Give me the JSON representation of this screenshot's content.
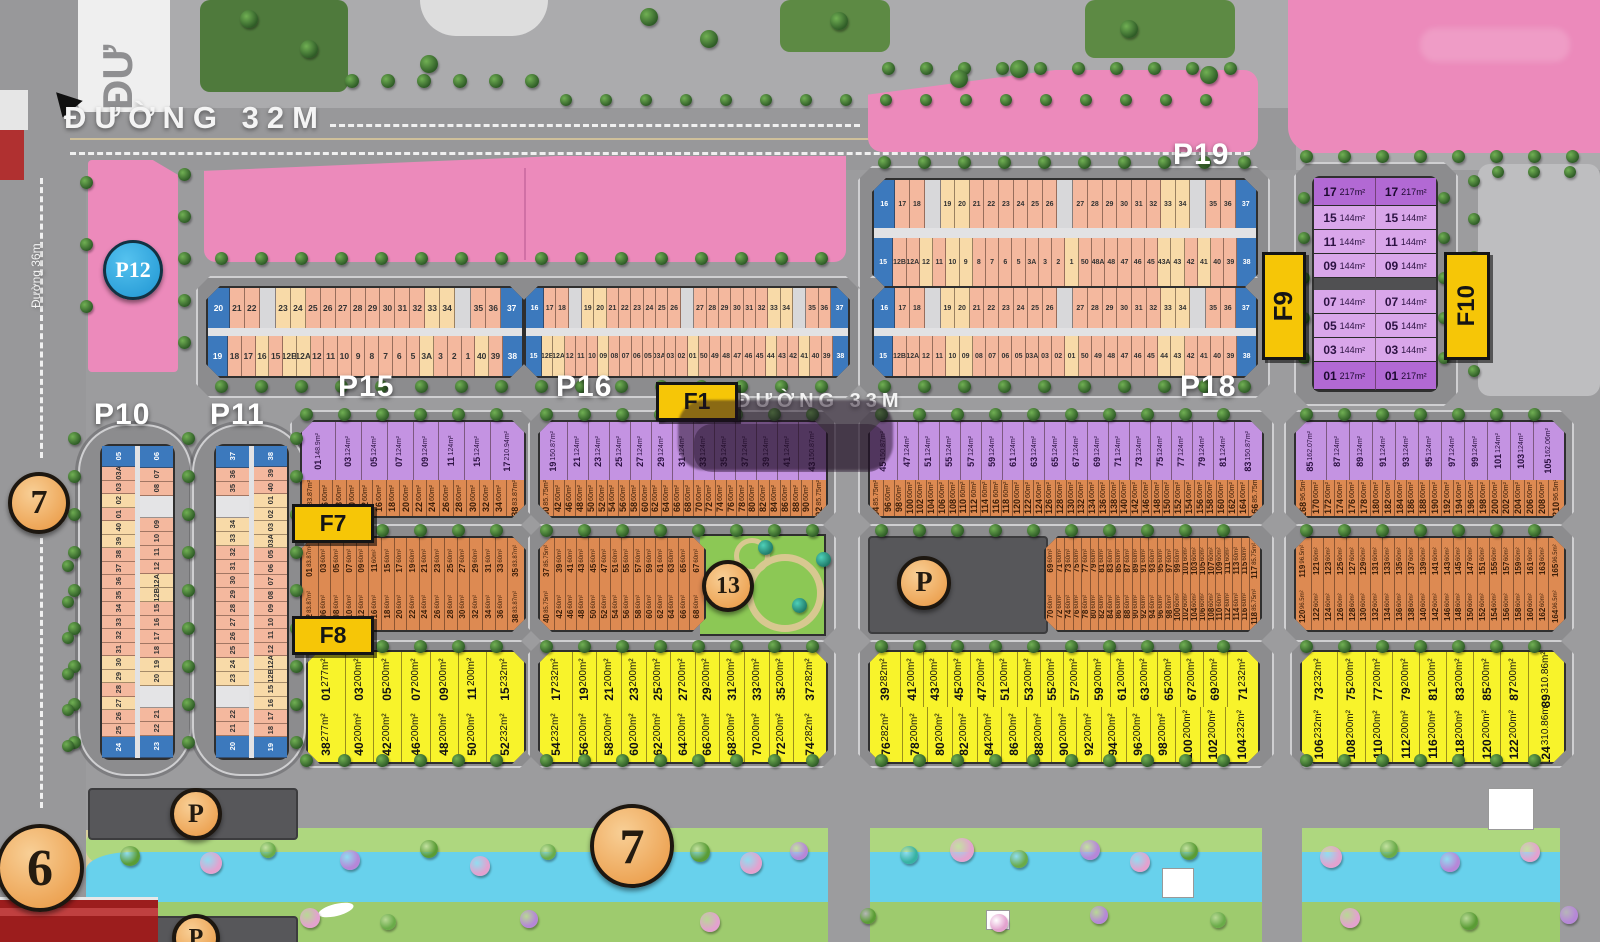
{
  "road_labels": {
    "top": "ĐƯỜNG 32M",
    "middle": "ĐƯỜNG 33M",
    "left_vertical": "Đường 36m",
    "top_left_partial": "ĐƯ"
  },
  "area_labels": {
    "p10": "P10",
    "p11": "P11",
    "p12": "P12",
    "p15": "P15",
    "p16": "P16",
    "p18": "P18",
    "p19": "P19"
  },
  "flag_labels": {
    "f1": "F1",
    "f7": "F7",
    "f8": "F8",
    "f9": "F9",
    "f10": "F10"
  },
  "markers": {
    "p12": "P12",
    "six": "6",
    "seven_road": "7",
    "seven_river": "7",
    "thirteen": "13",
    "parking": "P"
  },
  "colors": {
    "pink_building": "#ec8abb",
    "blue_plot": "#3c79bd",
    "salmon_plot": "#f4b89e",
    "cream_plot": "#f8daa8",
    "purple_plot": "#c493e2",
    "orange_plot": "#dd8a52",
    "yellow_plot": "#f8f32b",
    "flag_yellow": "#f6c607",
    "water": "#68d1ec",
    "bank_green": "#aed77f",
    "road_gray": "#9c9c9e",
    "marker_orange": "#e9953e",
    "marker_blue": "#1f95d2",
    "parking_gray": "#57575a",
    "red_band": "#9c1d1d"
  },
  "strips": {
    "p19": {
      "top": [
        [
          "16",
          "b"
        ],
        "17",
        "18",
        [
          "",
          "w"
        ],
        [
          "19",
          "c"
        ],
        [
          "20",
          "c"
        ],
        "21",
        "22",
        "23",
        "24",
        "25",
        "26",
        [
          "",
          "w"
        ],
        "27",
        "28",
        "29",
        "30",
        "31",
        "32",
        [
          "33",
          "c"
        ],
        [
          "34",
          "c"
        ],
        [
          "",
          "w"
        ],
        "35",
        "36",
        [
          "37",
          "b"
        ]
      ],
      "bottom": [
        [
          "15",
          "b"
        ],
        "12B",
        "12A",
        [
          "12",
          "c"
        ],
        "11",
        [
          "10",
          "c"
        ],
        [
          "9",
          "c"
        ],
        "8",
        "7",
        "6",
        "5",
        "3A",
        "3",
        "2",
        [
          "1",
          "c"
        ],
        "50",
        "48A",
        "48",
        "47",
        "46",
        "45",
        [
          "43A",
          "c"
        ],
        [
          "43",
          "c"
        ],
        "42",
        [
          "41",
          "c"
        ],
        "40",
        "39",
        [
          "38",
          "b"
        ]
      ]
    },
    "p18": {
      "top": [
        [
          "16",
          "b"
        ],
        "17",
        "18",
        [
          "",
          "w"
        ],
        [
          "19",
          "c"
        ],
        [
          "20",
          "c"
        ],
        "21",
        "22",
        "23",
        "24",
        "25",
        "26",
        [
          "",
          "w"
        ],
        "27",
        "28",
        "29",
        "30",
        "31",
        "32",
        [
          "33",
          "c"
        ],
        [
          "34",
          "c"
        ],
        [
          "",
          "w"
        ],
        "35",
        "36",
        [
          "37",
          "b"
        ]
      ],
      "bottom": [
        [
          "15",
          "b"
        ],
        "12B",
        "12A",
        "12",
        "11",
        [
          "10",
          "c"
        ],
        [
          "09",
          "c"
        ],
        "08",
        "07",
        "06",
        "05",
        "03A",
        "03",
        "02",
        [
          "01",
          "c"
        ],
        "50",
        "49",
        "48",
        "47",
        "46",
        "45",
        [
          "44",
          "c"
        ],
        [
          "43",
          "c"
        ],
        "42",
        "41",
        "40",
        "39",
        [
          "38",
          "b"
        ]
      ]
    },
    "p15": {
      "top": [
        [
          "20",
          "b"
        ],
        "21",
        "22",
        [
          "",
          "w"
        ],
        [
          "23",
          "c"
        ],
        [
          "24",
          "c"
        ],
        "25",
        "26",
        "27",
        "28",
        "29",
        "30",
        "31",
        "32",
        [
          "33",
          "c"
        ],
        [
          "34",
          "c"
        ],
        [
          "",
          "w"
        ],
        "35",
        "36",
        [
          "37",
          "b"
        ]
      ],
      "bottom": [
        [
          "19",
          "b"
        ],
        "18",
        "17",
        [
          "16",
          "c"
        ],
        "15",
        [
          "12B",
          "c"
        ],
        [
          "12A",
          "c"
        ],
        "12",
        "11",
        "10",
        "9",
        "8",
        "7",
        "6",
        "5",
        [
          "3A",
          "c"
        ],
        "3",
        "2",
        "1",
        [
          "40",
          "c"
        ],
        "39",
        [
          "38",
          "b"
        ]
      ]
    },
    "p16": {
      "top": [
        [
          "16",
          "b"
        ],
        "17",
        "18",
        [
          "",
          "w"
        ],
        [
          "19",
          "c"
        ],
        [
          "20",
          "c"
        ],
        "21",
        "22",
        "23",
        "24",
        "25",
        "26",
        [
          "",
          "w"
        ],
        "27",
        "28",
        "29",
        "30",
        "31",
        "32",
        [
          "33",
          "c"
        ],
        [
          "34",
          "c"
        ],
        [
          "",
          "w"
        ],
        "35",
        "36",
        [
          "37",
          "b"
        ]
      ],
      "bottom": [
        [
          "15",
          "b"
        ],
        [
          "12B",
          "c"
        ],
        [
          "12A",
          "c"
        ],
        "12",
        "11",
        "10",
        [
          "09",
          "c"
        ],
        "08",
        "07",
        "06",
        "05",
        "03A",
        "03",
        "02",
        [
          "01",
          "c"
        ],
        "50",
        "49",
        "48",
        "47",
        "46",
        "45",
        [
          "44",
          "c"
        ],
        "43",
        "42",
        [
          "41",
          "c"
        ],
        "40",
        "39",
        [
          "38",
          "b"
        ]
      ]
    }
  },
  "vstrips": {
    "p10": {
      "left": [
        [
          "05",
          "b"
        ],
        "03A",
        "03",
        [
          "02",
          "c"
        ],
        "01",
        [
          "40",
          "c"
        ],
        [
          "39",
          "c"
        ],
        "38",
        "37",
        "36",
        "35",
        "34",
        "33",
        "32",
        "31",
        [
          "30",
          "c"
        ],
        [
          "29",
          "c"
        ],
        "28",
        [
          "27",
          "c"
        ],
        "26",
        "25",
        [
          "24",
          "b"
        ]
      ],
      "right": [
        [
          "06",
          "b"
        ],
        "07",
        "08",
        [
          "",
          "g"
        ],
        "09",
        "10",
        "11",
        "12",
        [
          "12A",
          "c"
        ],
        [
          "12B",
          "c"
        ],
        "15",
        "16",
        "17",
        "18",
        [
          "19",
          "c"
        ],
        [
          "20",
          "c"
        ],
        [
          "",
          "g"
        ],
        "21",
        "22",
        [
          "23",
          "b"
        ]
      ]
    },
    "p11": {
      "left": [
        [
          "37",
          "b"
        ],
        "36",
        "35",
        [
          "",
          "g"
        ],
        [
          "34",
          "c"
        ],
        [
          "33",
          "c"
        ],
        "32",
        "31",
        "30",
        "29",
        "28",
        "27",
        "26",
        "25",
        [
          "24",
          "c"
        ],
        [
          "23",
          "c"
        ],
        [
          "",
          "g"
        ],
        "22",
        "21",
        [
          "20",
          "b"
        ]
      ],
      "right": [
        [
          "38",
          "b"
        ],
        "39",
        "40",
        [
          "01",
          "c"
        ],
        [
          "02",
          "c"
        ],
        [
          "03",
          "c"
        ],
        [
          "03A",
          "c"
        ],
        "05",
        "06",
        "07",
        "08",
        "09",
        "10",
        "11",
        "12",
        [
          "12A",
          "c"
        ],
        [
          "12B",
          "c"
        ],
        [
          "15",
          "c"
        ],
        [
          "16",
          "c"
        ],
        "17",
        "18",
        [
          "19",
          "b"
        ]
      ]
    }
  },
  "f9f10_block": {
    "column_cells": [
      [
        "17",
        "217m²",
        "d"
      ],
      [
        "15",
        "144m²",
        "l"
      ],
      [
        "11",
        "144m²",
        "l"
      ],
      [
        "09",
        "144m²",
        "l"
      ],
      [
        "07",
        "144m²",
        "l"
      ],
      [
        "05",
        "144m²",
        "l"
      ],
      [
        "03",
        "144m²",
        "l"
      ],
      [
        "01",
        "217m²",
        "d"
      ]
    ],
    "columns": 2
  },
  "row1": {
    "purple_default_area": "124m²",
    "orange_default_area": "60m²",
    "sections": [
      {
        "purple": [
          [
            "01",
            "148.9m²"
          ],
          "03",
          "05",
          "07",
          "09",
          "11",
          "15",
          [
            "17",
            "210.94m²"
          ]
        ],
        "orange": [
          [
            "02",
            "83.87m²"
          ],
          "06",
          "08",
          "10",
          "12",
          "16",
          "18",
          "20",
          "22",
          "24",
          "26",
          "28",
          "30",
          "32",
          "34",
          [
            "38",
            "83.87m²"
          ]
        ]
      },
      {
        "purple": [
          [
            "19",
            "150.87m²"
          ],
          "21",
          "23",
          "25",
          "27",
          "29",
          "31",
          "33",
          "35",
          "37",
          "39",
          "41",
          [
            "43",
            "150.87m²"
          ]
        ],
        "orange": [
          [
            "40",
            "85.75m²"
          ],
          "42",
          "46",
          "48",
          "50",
          "52",
          "54",
          "56",
          "58",
          "60",
          "62",
          "64",
          "66",
          "68",
          "70",
          "72",
          "74",
          "76",
          "78",
          "80",
          "82",
          "84",
          "86",
          "88",
          "90",
          [
            "92",
            "85.75m²"
          ]
        ]
      },
      {
        "purple": [
          [
            "45",
            "150.87m²"
          ],
          "47",
          "51",
          "55",
          "57",
          "59",
          "61",
          "63",
          "65",
          "67",
          "69",
          "71",
          "73",
          "75",
          "77",
          "79",
          "81",
          [
            "83",
            "150.87m²"
          ]
        ],
        "orange": [
          [
            "94",
            "85.75m²"
          ],
          "96",
          "98",
          "100",
          "102",
          "104",
          "106",
          "108",
          "110",
          "112",
          "114",
          "116",
          "118",
          "120",
          "122",
          "124",
          "126",
          "128",
          "130",
          "132",
          "134",
          "136",
          "138",
          "140",
          "142",
          "146",
          "148",
          "150",
          "152",
          "154",
          "156",
          "158",
          "160",
          "162",
          "164",
          [
            "166",
            "85.75m²"
          ]
        ]
      },
      {
        "purple": [
          [
            "85",
            "162.07m²"
          ],
          "87",
          "89",
          "91",
          "93",
          "95",
          "97",
          "99",
          "101",
          "103",
          [
            "105",
            "162.06m²"
          ]
        ],
        "orange": [
          [
            "168",
            "96.5m²"
          ],
          "170",
          "172",
          "174",
          "176",
          "178",
          "180",
          "182",
          "184",
          "186",
          "188",
          "190",
          "192",
          "194",
          "196",
          "198",
          "200",
          "202",
          "204",
          "206",
          "208",
          [
            "210",
            "96.5m²"
          ]
        ]
      }
    ]
  },
  "row2": {
    "default_area": "60m²",
    "sections": [
      {
        "top": [
          [
            "01",
            "83.87m²"
          ],
          "03",
          "05",
          "07",
          "09",
          "11",
          "15",
          "17",
          "19",
          "21",
          "23",
          "25",
          "27",
          "29",
          "31",
          "33",
          [
            "35",
            "83.87m²"
          ]
        ],
        "bottom": [
          [
            "02",
            "83.87m²"
          ],
          "06",
          "08",
          "10",
          "12",
          "16",
          "18",
          "20",
          "22",
          "24",
          "26",
          "28",
          "30",
          "32",
          "34",
          "36",
          [
            "38",
            "83.87m²"
          ]
        ]
      },
      {
        "top": [
          [
            "37",
            "85.75m²"
          ],
          "39",
          "41",
          "43",
          "45",
          "47",
          "51",
          "55",
          "57",
          "59",
          "61",
          "63",
          "65",
          "67"
        ],
        "bottom": [
          [
            "40",
            "85.75m²"
          ],
          "42",
          "46",
          "48",
          "50",
          "52",
          "54",
          "56",
          "58",
          "60",
          "62",
          "64",
          "66",
          "68"
        ],
        "park": true
      },
      {
        "top": [
          "69",
          "71",
          "73",
          "75",
          "77",
          "79",
          "81",
          "83",
          "85",
          "87",
          "89",
          "91",
          "93",
          "95",
          "97",
          "99",
          "101",
          "103",
          "105",
          "107",
          "109",
          "111",
          "113",
          "115",
          [
            "117",
            "85.75m²"
          ]
        ],
        "bottom": [
          "70",
          "72",
          "74",
          "76",
          "78",
          "80",
          "82",
          "84",
          "86",
          "88",
          "90",
          "92",
          "94",
          "96",
          "98",
          "100",
          "102",
          "104",
          "106",
          "108",
          "110",
          "112",
          "114",
          "116",
          [
            "118",
            "85.75m²"
          ]
        ],
        "parking": true
      },
      {
        "top": [
          [
            "119",
            "96.5m²"
          ],
          "121",
          "123",
          "125",
          "127",
          "129",
          "131",
          "133",
          "135",
          "137",
          "139",
          "141",
          "143",
          "145",
          "147",
          "151",
          "155",
          "157",
          "159",
          "161",
          "163",
          [
            "165",
            "96.5m²"
          ]
        ],
        "bottom": [
          [
            "120",
            "96.5m²"
          ],
          "122",
          "124",
          "126",
          "128",
          "130",
          "132",
          "134",
          "136",
          "138",
          "140",
          "142",
          "146",
          "148",
          "150",
          "152",
          "154",
          "156",
          "158",
          "160",
          "162",
          [
            "164",
            "96.5m²"
          ]
        ]
      }
    ]
  },
  "row3": {
    "default_area": "200m²",
    "sections": [
      {
        "top": [
          [
            "01",
            "277m²"
          ],
          "03",
          "05",
          "07",
          "09",
          "11",
          [
            "15",
            "232m²"
          ]
        ],
        "bottom": [
          [
            "38",
            "277m²"
          ],
          "40",
          "42",
          "46",
          "48",
          "50",
          [
            "52",
            "232m²"
          ]
        ]
      },
      {
        "top": [
          [
            "17",
            "232m²"
          ],
          "19",
          "21",
          "23",
          "25",
          "27",
          "29",
          "31",
          "33",
          "35",
          [
            "37",
            "282m²"
          ]
        ],
        "bottom": [
          [
            "54",
            "232m²"
          ],
          "56",
          "58",
          "60",
          "62",
          "64",
          "66",
          "68",
          "70",
          "72",
          [
            "74",
            "282m²"
          ]
        ]
      },
      {
        "top": [
          [
            "39",
            "282m²"
          ],
          "41",
          "43",
          "45",
          "47",
          "51",
          "53",
          "55",
          "57",
          "59",
          "61",
          "63",
          "65",
          "67",
          "69",
          [
            "71",
            "232m²"
          ]
        ],
        "bottom": [
          [
            "76",
            "282m²"
          ],
          "78",
          "80",
          "82",
          "84",
          "86",
          "88",
          "90",
          "92",
          "94",
          "96",
          "98",
          "100",
          "102",
          [
            "104",
            "232m²"
          ]
        ]
      },
      {
        "top": [
          [
            "73",
            "232m²"
          ],
          "75",
          "77",
          "79",
          "81",
          "83",
          "85",
          "87",
          [
            "89",
            "310.86m²"
          ]
        ],
        "bottom": [
          [
            "106",
            "232m²"
          ],
          "108",
          "110",
          "112",
          "116",
          "118",
          "120",
          "122",
          [
            "124",
            "310.86m²"
          ]
        ]
      }
    ]
  }
}
